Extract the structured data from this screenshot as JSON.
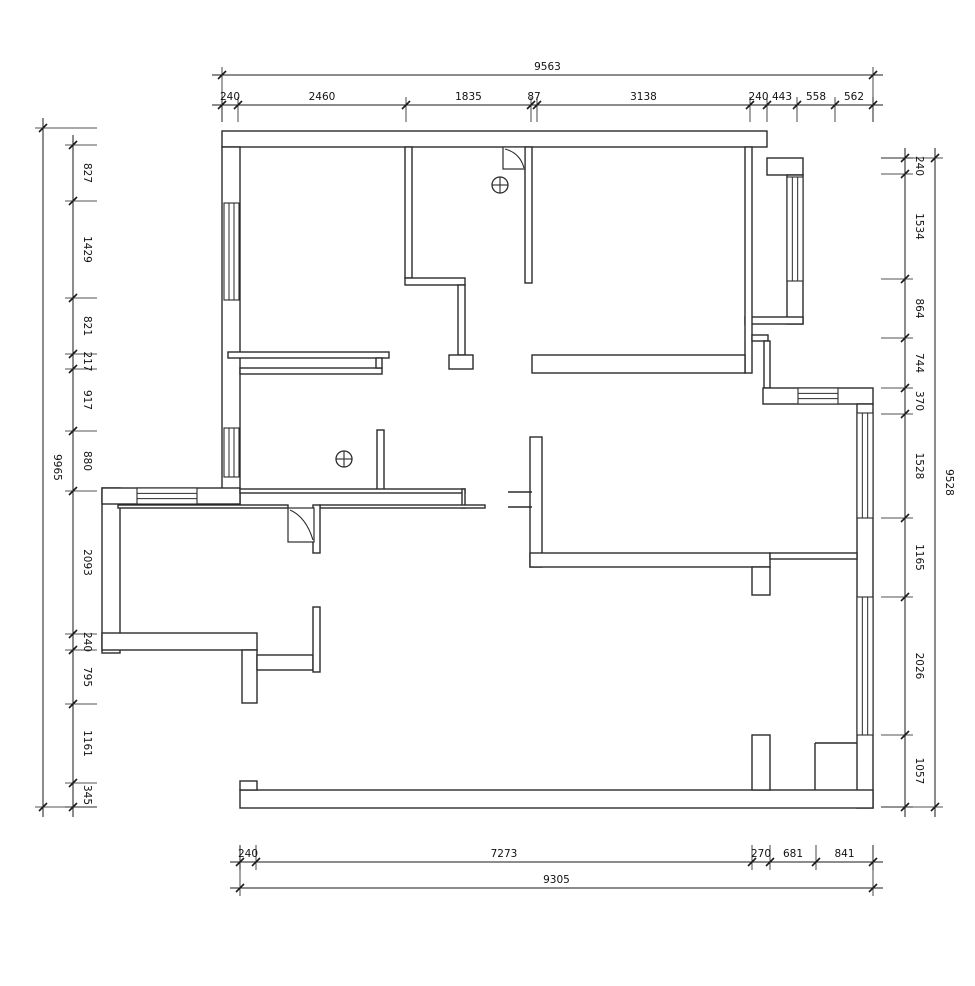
{
  "canvas": {
    "width": 975,
    "height": 986,
    "background": "#ffffff",
    "wall_color": "#2b2b2b",
    "dim_color": "#1a1a1a",
    "dim_font_px": 10.5
  },
  "plan": {
    "walls": [
      {
        "n": "top-wall",
        "r": [
          222,
          131,
          545,
          16
        ]
      },
      {
        "n": "left-wall",
        "r": [
          222,
          147,
          18,
          358
        ]
      },
      {
        "n": "bay-top-wall",
        "r": [
          767,
          158,
          36,
          17
        ]
      },
      {
        "n": "bay-right-wall",
        "r": [
          787,
          175,
          16,
          149
        ]
      },
      {
        "n": "bay-bottom-wall",
        "r": [
          745,
          317,
          58,
          7
        ]
      },
      {
        "n": "bedroom2-right-wall",
        "r": [
          745,
          147,
          7,
          226
        ]
      },
      {
        "n": "right-step-wall-h",
        "r": [
          752,
          335,
          16,
          6
        ]
      },
      {
        "n": "right-step-wall-v",
        "r": [
          764,
          341,
          6,
          47
        ]
      },
      {
        "n": "right-top-wall",
        "r": [
          763,
          388,
          110,
          16
        ]
      },
      {
        "n": "right-wall",
        "r": [
          857,
          404,
          16,
          404
        ]
      },
      {
        "n": "bottom-wall",
        "r": [
          240,
          790,
          633,
          18
        ]
      },
      {
        "n": "bottom-wall-step",
        "r": [
          240,
          781,
          17,
          9
        ]
      },
      {
        "n": "wing-west-wall",
        "r": [
          102,
          488,
          18,
          165
        ]
      },
      {
        "n": "wing-top-wall",
        "r": [
          102,
          488,
          138,
          16
        ]
      },
      {
        "n": "wing-bottom-wall",
        "r": [
          102,
          633,
          155,
          17
        ]
      },
      {
        "n": "wing-pier",
        "r": [
          242,
          650,
          15,
          53
        ]
      },
      {
        "n": "bedroom1-south-wall-a",
        "r": [
          228,
          352,
          161,
          6
        ]
      },
      {
        "n": "bedroom1-south-wall-b",
        "r": [
          240,
          368,
          142,
          6
        ]
      },
      {
        "n": "bedroom1-south-connector",
        "r": [
          376,
          358,
          6,
          10
        ]
      },
      {
        "n": "bedroom1-east-wall",
        "r": [
          405,
          147,
          7,
          131
        ]
      },
      {
        "n": "midroom-south-wall",
        "r": [
          405,
          278,
          60,
          7
        ]
      },
      {
        "n": "midroom-stub-wall",
        "r": [
          458,
          285,
          7,
          70
        ]
      },
      {
        "n": "midroom-stub-foot",
        "r": [
          449,
          355,
          24,
          14
        ]
      },
      {
        "n": "midroom-east-wall",
        "r": [
          525,
          147,
          7,
          136
        ]
      },
      {
        "n": "bedroom2-south-wall",
        "r": [
          532,
          355,
          213,
          18
        ]
      },
      {
        "n": "hall-stub-wall",
        "r": [
          377,
          430,
          7,
          60
        ]
      },
      {
        "n": "corridor-wall-upper",
        "r": [
          240,
          489,
          225,
          4
        ]
      },
      {
        "n": "corridor-wall-cap",
        "r": [
          462,
          489,
          3,
          19
        ]
      },
      {
        "n": "corridor-wall-lower-left",
        "r": [
          118,
          505,
          170,
          3
        ]
      },
      {
        "n": "corridor-wall-lower-right",
        "r": [
          320,
          505,
          165,
          3
        ]
      },
      {
        "n": "door-stub-wall",
        "r": [
          313,
          505,
          7,
          48
        ]
      },
      {
        "n": "living-west-wall",
        "r": [
          530,
          437,
          12,
          130
        ]
      },
      {
        "n": "living-south-wall",
        "r": [
          530,
          553,
          240,
          14
        ]
      },
      {
        "n": "living-south-pier",
        "r": [
          752,
          567,
          18,
          28
        ]
      },
      {
        "n": "living-east-thin-wall",
        "r": [
          770,
          553,
          87,
          6
        ]
      },
      {
        "n": "nook-wall-h",
        "r": [
          257,
          655,
          56,
          15
        ]
      },
      {
        "n": "nook-wall-v",
        "r": [
          313,
          607,
          7,
          65
        ]
      },
      {
        "n": "bottom-pier",
        "r": [
          752,
          735,
          18,
          55
        ]
      }
    ],
    "lines": [
      {
        "n": "living-entry-mark-1",
        "p": [
          508,
          492,
          532,
          492
        ]
      },
      {
        "n": "living-entry-mark-2",
        "p": [
          508,
          507,
          532,
          507
        ]
      },
      {
        "n": "corner-step-v",
        "p": [
          815,
          790,
          815,
          743
        ]
      },
      {
        "n": "corner-step-h",
        "p": [
          815,
          743,
          857,
          743
        ]
      }
    ],
    "windows": [
      {
        "n": "window-left-upper",
        "r": [
          224,
          203,
          15,
          97
        ],
        "dir": "v"
      },
      {
        "n": "window-left-lower",
        "r": [
          224,
          428,
          15,
          49
        ],
        "dir": "v"
      },
      {
        "n": "window-wing-top",
        "r": [
          137,
          488,
          60,
          16
        ],
        "dir": "h"
      },
      {
        "n": "window-bay-right",
        "r": [
          787,
          177,
          16,
          104
        ],
        "dir": "v"
      },
      {
        "n": "window-right-top",
        "r": [
          798,
          388,
          40,
          16
        ],
        "dir": "h"
      },
      {
        "n": "window-right-upper",
        "r": [
          857,
          413,
          16,
          105
        ],
        "dir": "v"
      },
      {
        "n": "window-right-lower",
        "r": [
          857,
          597,
          16,
          138
        ],
        "dir": "v"
      }
    ],
    "doors": [
      {
        "n": "door-midroom",
        "sq": [
          503,
          147,
          22,
          22
        ],
        "c": [
          505,
          149,
          520,
          153,
          524,
          168
        ]
      },
      {
        "n": "door-corridor",
        "sq": [
          288,
          508,
          26,
          34
        ],
        "c": [
          290,
          510,
          306,
          517,
          313,
          540
        ]
      }
    ],
    "symbols": [
      {
        "n": "crosshair-symbol-1",
        "x": 500,
        "y": 185,
        "r": 8
      },
      {
        "n": "crosshair-symbol-2",
        "x": 344,
        "y": 459,
        "r": 8
      }
    ]
  },
  "dims": {
    "top": {
      "chain": {
        "line": 105,
        "ticks": [
          222,
          238,
          406,
          531,
          537,
          750,
          767,
          797,
          835,
          873
        ],
        "labels": [
          "240",
          "2460",
          "1835",
          "87",
          "3138",
          "240",
          "443",
          "558",
          "562"
        ]
      },
      "total": {
        "line": 75,
        "from": 222,
        "to": 873,
        "label": "9563"
      }
    },
    "left": {
      "chain": {
        "line": 73,
        "ticks": [
          145,
          201,
          298,
          354,
          369,
          431,
          491,
          634,
          650,
          704,
          783,
          807
        ],
        "labels": [
          "827",
          "1429",
          "821",
          "217",
          "917",
          "880",
          "2093",
          "240",
          "795",
          "1161",
          "345"
        ]
      },
      "total": {
        "line": 43,
        "from": 128,
        "to": 807,
        "label": "9965"
      }
    },
    "right": {
      "chain": {
        "line": 905,
        "ticks": [
          158,
          174,
          279,
          338,
          388,
          414,
          518,
          597,
          735,
          807
        ],
        "labels": [
          "240",
          "1534",
          "864",
          "744",
          "370",
          "1528",
          "1165",
          "2026",
          "1057"
        ]
      },
      "total": {
        "line": 935,
        "from": 158,
        "to": 807,
        "label": "9528"
      }
    },
    "bottom": {
      "chain": {
        "line": 862,
        "ticks": [
          240,
          256,
          752,
          770,
          816,
          873
        ],
        "labels": [
          "240",
          "7273",
          "270",
          "681",
          "841"
        ]
      },
      "total": {
        "line": 888,
        "from": 240,
        "to": 873,
        "label": "9305"
      }
    }
  }
}
